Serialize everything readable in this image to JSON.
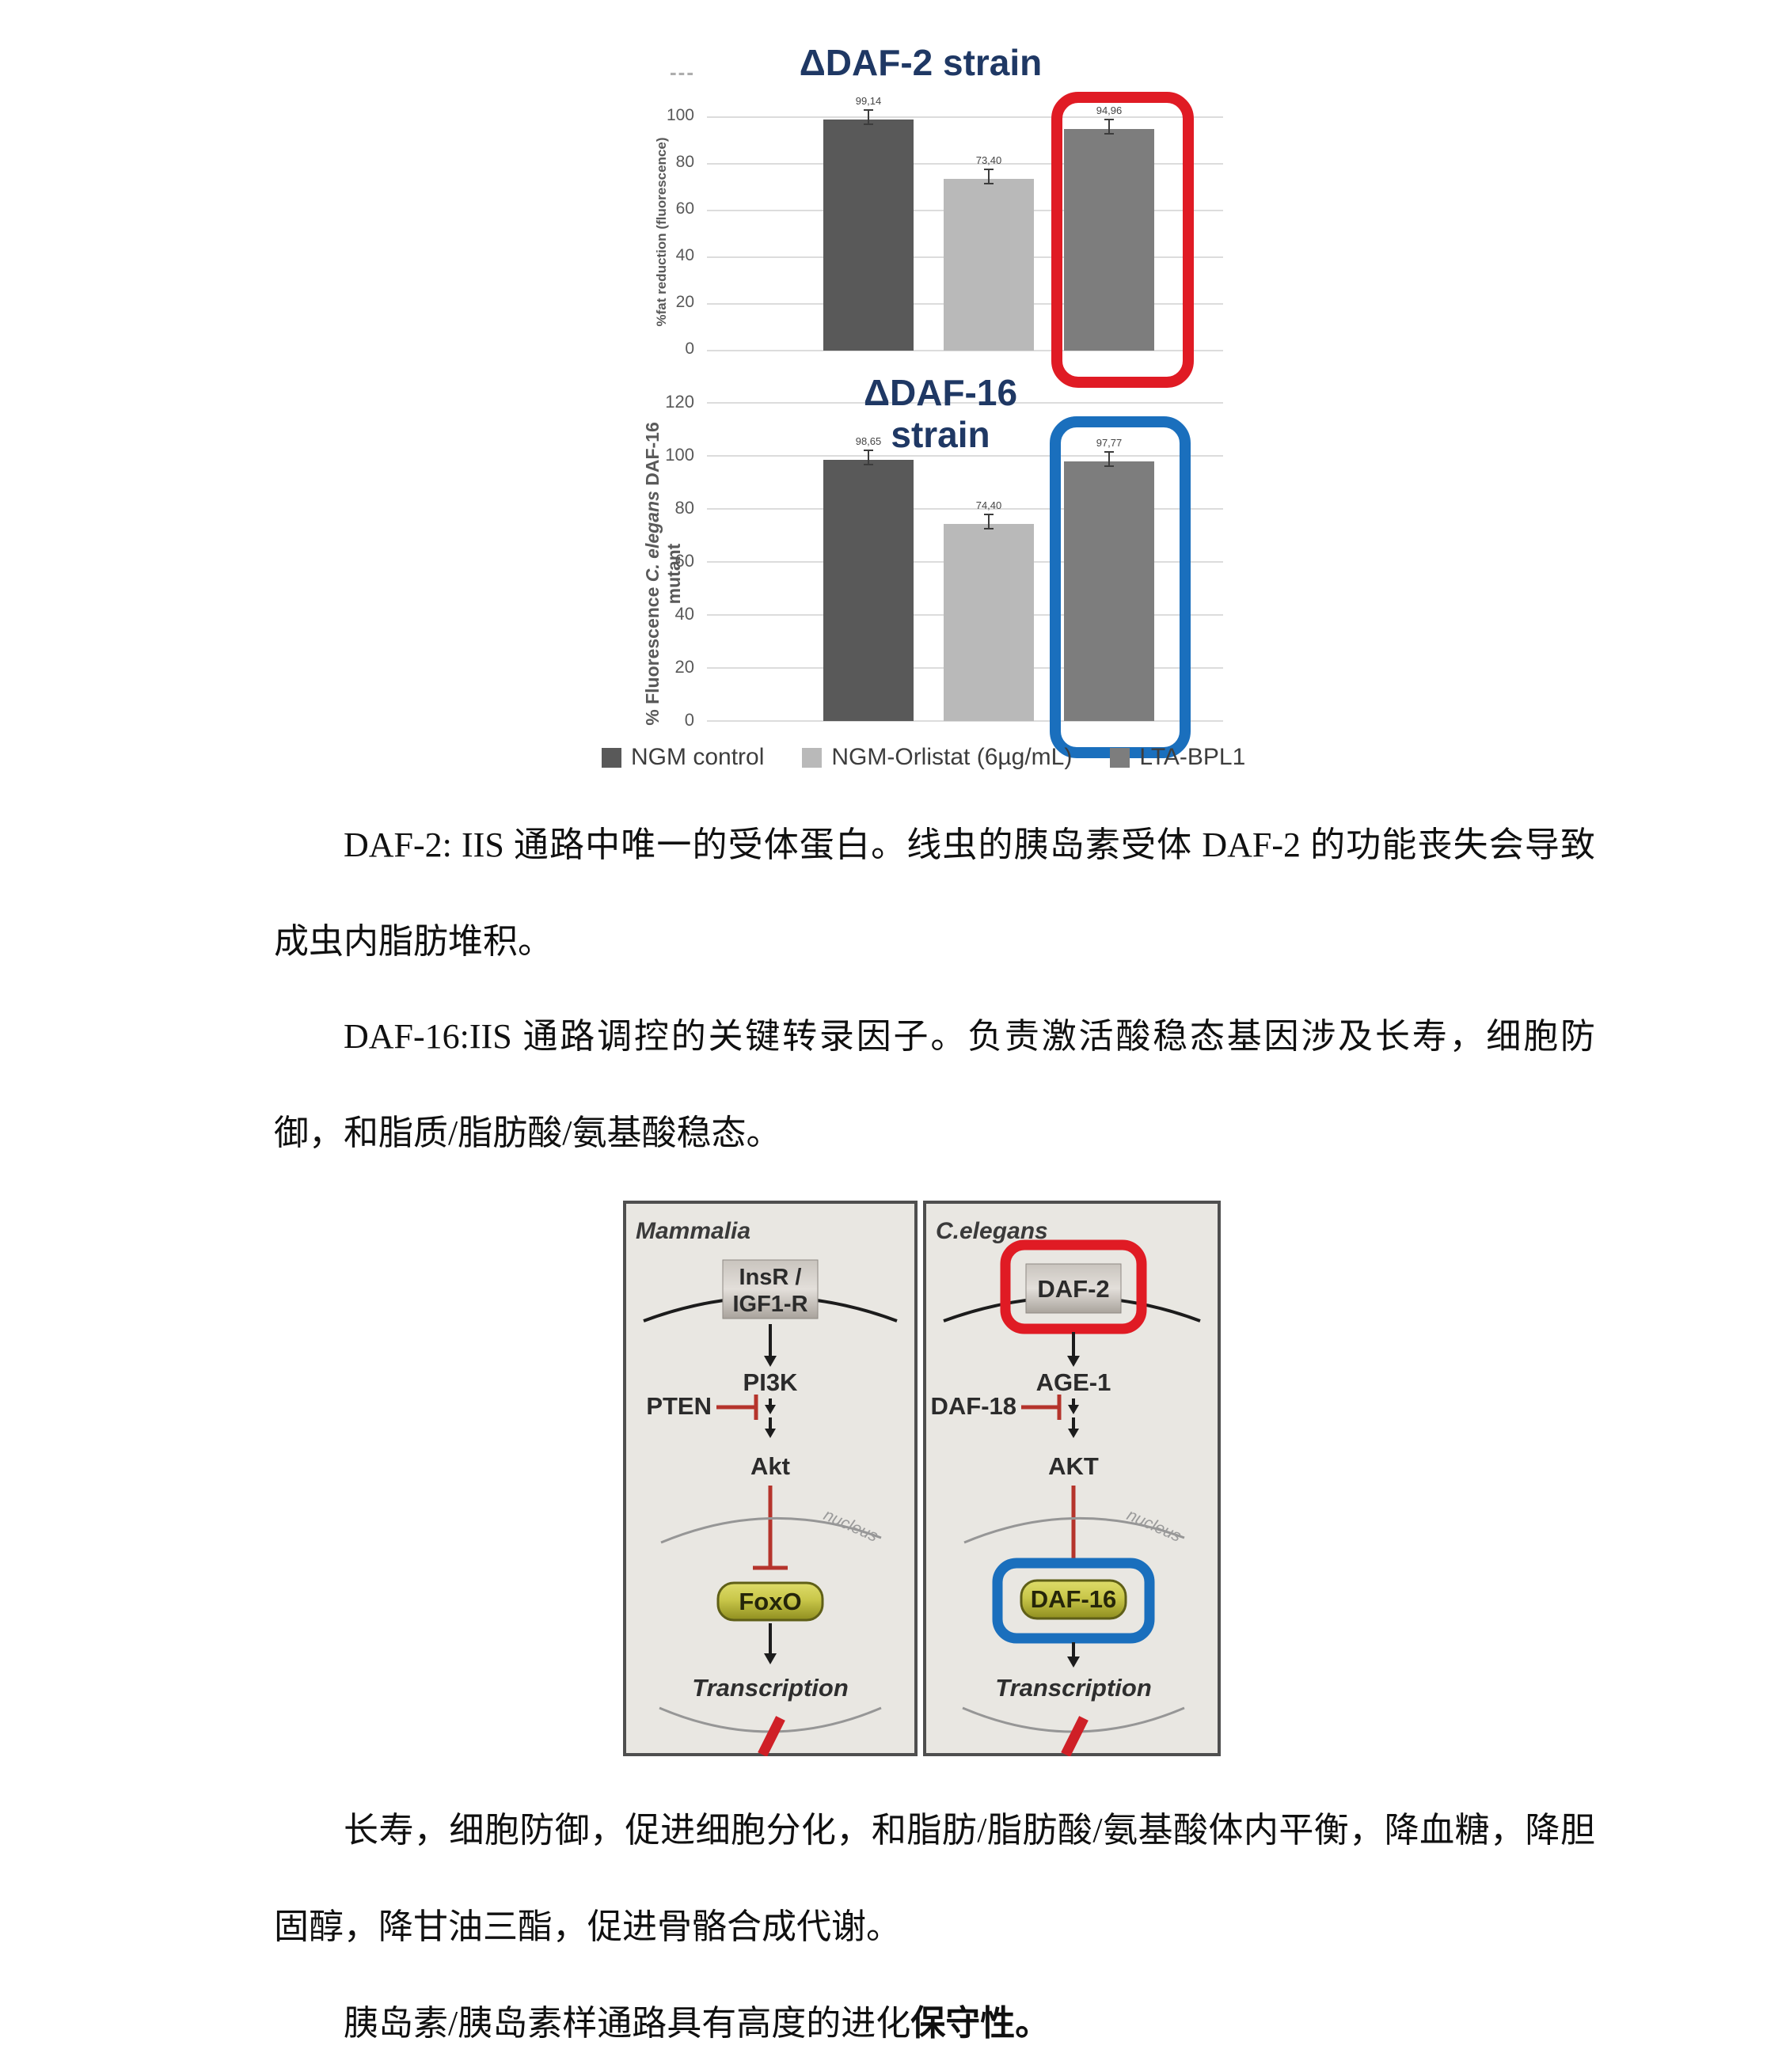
{
  "figure": {
    "stray_dashes": "---",
    "legend": {
      "items": [
        {
          "label": "NGM control",
          "color": "#595959"
        },
        {
          "label": "NGM-Orlistat (6µg/mL)",
          "color": "#b9b9b9"
        },
        {
          "label": "LTA-BPL1",
          "color": "#7d7d7d"
        }
      ]
    }
  },
  "chart_data": [
    {
      "type": "bar",
      "title": "ΔDAF-2 strain",
      "title_color": "#1f3864",
      "ylabel": "%fat reduction (fluorescence)",
      "categories": [
        "NGM control",
        "NGM-Orlistat (6µg/mL)",
        "LTA-BPL1"
      ],
      "values": [
        99.14,
        73.4,
        94.96
      ],
      "value_labels": [
        "99,14",
        "73,40",
        "94,96"
      ],
      "bar_colors": [
        "#595959",
        "#b9b9b9",
        "#7d7d7d"
      ],
      "error_bars": true,
      "yticks": [
        0,
        20,
        40,
        60,
        80,
        100
      ],
      "ylim": [
        0,
        100
      ],
      "grid": true,
      "legend_position": "shared-bottom",
      "highlight": {
        "category": "LTA-BPL1",
        "index": 2,
        "ring_color": "#e01b24"
      }
    },
    {
      "type": "bar",
      "title": "ΔDAF-16 strain",
      "title_lines": [
        "ΔDAF-16",
        "strain"
      ],
      "title_color": "#1f3864",
      "ylabel": "% Fluorescence C. elegans DAF-16 mutant",
      "ylabel_parts": {
        "prefix": "% Fluorescence ",
        "italic": "C. elegans",
        "suffix": " DAF-16 mutant"
      },
      "categories": [
        "NGM control",
        "NGM-Orlistat (6µg/mL)",
        "LTA-BPL1"
      ],
      "values": [
        98.65,
        74.4,
        97.77
      ],
      "value_labels": [
        "98,65",
        "74,40",
        "97,77"
      ],
      "bar_colors": [
        "#595959",
        "#b9b9b9",
        "#7d7d7d"
      ],
      "error_bars": true,
      "yticks": [
        0,
        20,
        40,
        60,
        80,
        100,
        120
      ],
      "ylim": [
        0,
        120
      ],
      "grid": true,
      "legend_position": "shared-bottom",
      "highlight": {
        "category": "LTA-BPL1",
        "index": 2,
        "ring_color": "#1a6fbd"
      }
    }
  ],
  "diagram": {
    "left": {
      "species": "Mammalia",
      "receptor_line1": "InsR /",
      "receptor_line2": "IGF1-R",
      "kinase": "PI3K",
      "inhibitor": "PTEN",
      "akt": "Akt",
      "nucleus": "nucleus",
      "tf": "FoxO",
      "transcription": "Transcription"
    },
    "right": {
      "species": "C.elegans",
      "receptor": "DAF-2",
      "kinase": "AGE-1",
      "inhibitor": "DAF-18",
      "akt": "AKT",
      "nucleus": "nucleus",
      "tf": "DAF-16",
      "transcription": "Transcription"
    }
  },
  "paragraphs": {
    "p1": "DAF-2: IIS 通路中唯一的受体蛋白。线虫的胰岛素受体 DAF-2 的功能丧失会导致成虫内脂肪堆积。",
    "p2": "DAF-16:IIS 通路调控的关键转录因子。负责激活酸稳态基因涉及长寿，细胞防御，和脂质/脂肪酸/氨基酸稳态。",
    "p3": "长寿，细胞防御，促进细胞分化，和脂肪/脂肪酸/氨基酸体内平衡，降血糖，降胆固醇，降甘油三酯，促进骨骼合成代谢。",
    "p4_normal": "胰岛素/胰岛素样通路具有高度的进化",
    "p4_bold": "保守性。"
  }
}
